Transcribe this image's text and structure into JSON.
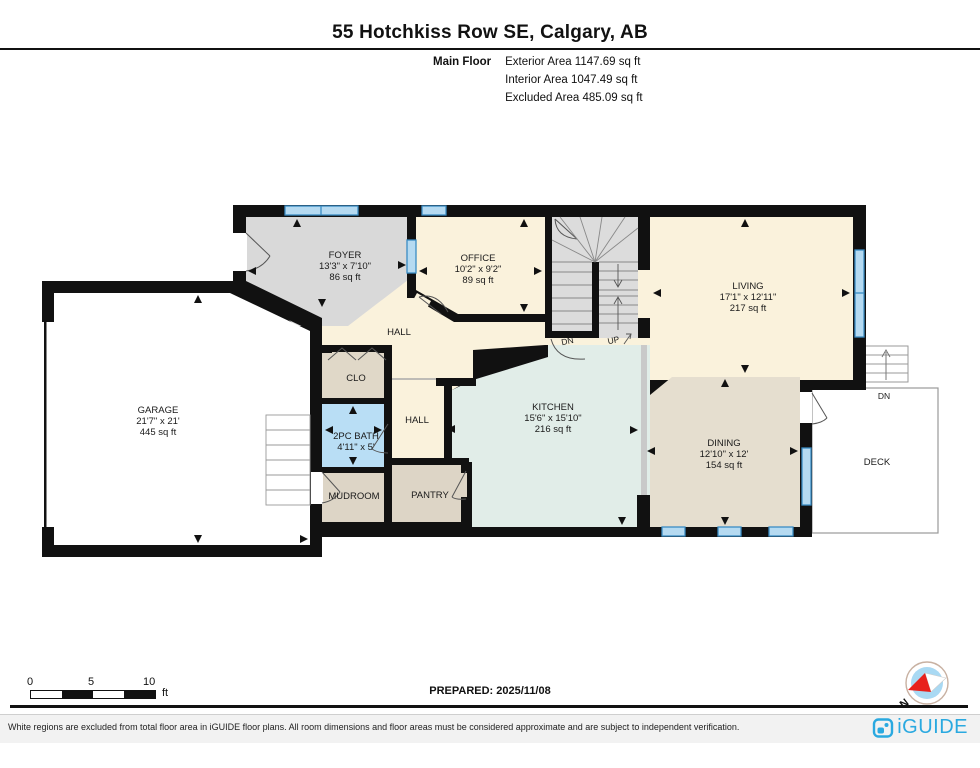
{
  "header": {
    "address": "55 Hotchkiss Row SE, Calgary, AB",
    "floor_label": "Main Floor",
    "exterior_area": "Exterior Area 1147.69 sq ft",
    "interior_area": "Interior Area 1047.49 sq ft",
    "excluded_area": "Excluded Area 485.09 sq ft"
  },
  "rooms": {
    "foyer": {
      "name": "FOYER",
      "dims": "13'3\" x 7'10\"",
      "area": "86 sq ft"
    },
    "office": {
      "name": "OFFICE",
      "dims": "10'2\" x 9'2\"",
      "area": "89 sq ft"
    },
    "living": {
      "name": "LIVING",
      "dims": "17'1\" x 12'11\"",
      "area": "217 sq ft"
    },
    "kitchen": {
      "name": "KITCHEN",
      "dims": "15'6\" x 15'10\"",
      "area": "216 sq ft"
    },
    "dining": {
      "name": "DINING",
      "dims": "12'10\" x 12'",
      "area": "154 sq ft"
    },
    "garage": {
      "name": "GARAGE",
      "dims": "21'7\" x 21'",
      "area": "445 sq ft"
    },
    "bath": {
      "name": "2PC BATH",
      "dims": "4'11\" x 5'"
    },
    "hall_upper": {
      "name": "HALL"
    },
    "hall_lower": {
      "name": "HALL"
    },
    "closet": {
      "name": "CLO"
    },
    "mudroom": {
      "name": "MUDROOM"
    },
    "pantry": {
      "name": "PANTRY"
    },
    "deck": {
      "name": "DECK"
    }
  },
  "stairs": {
    "down_label": "DN",
    "up_label": "UP",
    "deck_down_label": "DN"
  },
  "scale_bar": {
    "tick_0": "0",
    "tick_5": "5",
    "tick_10": "10",
    "unit": "ft"
  },
  "compass": {
    "north_label": "N"
  },
  "footer": {
    "prepared": "PREPARED: 2025/11/08",
    "disclaimer": "White regions are excluded from total floor area in iGUIDE floor plans. All room dimensions and floor areas must be considered approximate and are subject to independent verification.",
    "brand": "iGUIDE"
  },
  "colors": {
    "wall": "#111111",
    "window_fill": "#b5daf1",
    "window_border": "#3a8cc4",
    "cream_room": "#faf2dc",
    "gray_room": "#d9d9d9",
    "stair_gray": "#dcdcdc",
    "kitchen_teal": "#e1ede8",
    "dining_tan": "#e5decf",
    "closet_tan": "#e0d8c8",
    "bath_blue": "#b9def5",
    "brand_blue": "#2aa9e0",
    "compass_red": "#e8211d",
    "compass_disc": "#a9d9f3"
  }
}
